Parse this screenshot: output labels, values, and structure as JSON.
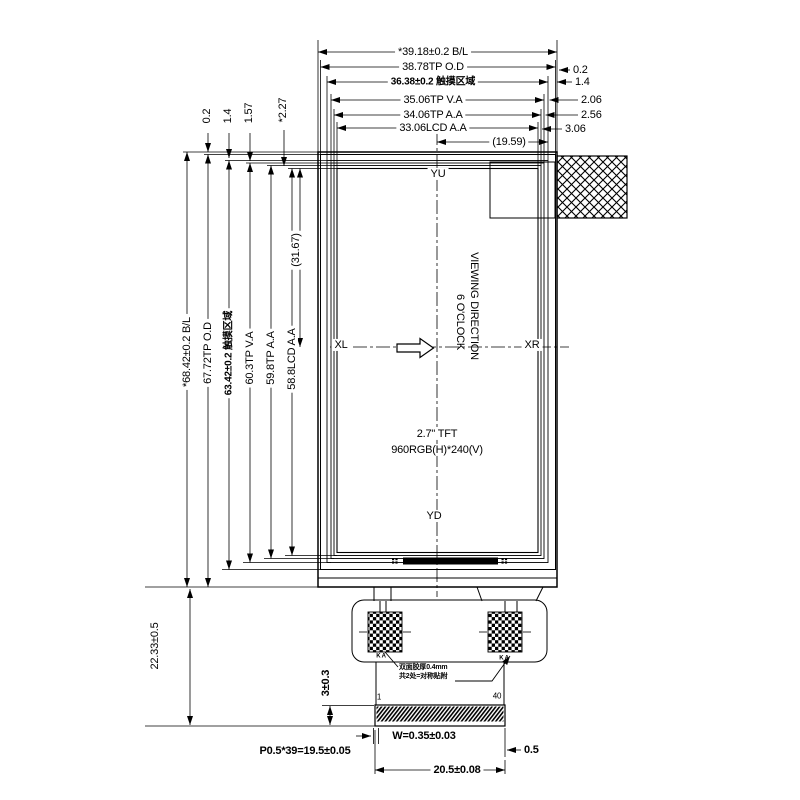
{
  "dims": {
    "top": [
      "*39.18±0.2 B/L",
      "38.78TP O.D",
      "36.38±0.2 触摸区域",
      "35.06TP V.A",
      "34.06TP A.A",
      "33.06LCD A.A"
    ],
    "top_half": "(19.59)",
    "right_offsets": [
      "0.2",
      "1.4",
      "2.06",
      "2.56",
      "3.06"
    ],
    "left": [
      "*68.42±0.2 B/L",
      "67.72TP O.D",
      "63.42±0.2 触摸区域",
      "60.3TP V.A",
      "59.8TP A.A",
      "58.8LCD A.A"
    ],
    "left_offsets": [
      "0.2",
      "1.4",
      "1.57",
      "*2.27"
    ],
    "left_half": "(31.67)",
    "bottom_height": "22.33±0.5",
    "fpc_connector_height": "3±0.3",
    "pin_pitch": "P0.5*39=19.5±0.05",
    "pin_width": "W=0.35±0.03",
    "edge_margin": "0.5",
    "connector_width": "20.5±0.08"
  },
  "panel": {
    "axis_top": "YU",
    "axis_bottom": "YD",
    "axis_left": "XL",
    "axis_right": "XR",
    "viewing_line1": "VIEWING DIRECTION",
    "viewing_line2": "6 O'CLOCK",
    "size_line1": "2.7\" TFT",
    "size_line2": "960RGB(H)*240(V)"
  },
  "fpc": {
    "pin_first": "1",
    "pin_last": "40",
    "pad_label_left": "K A",
    "pad_label_right": "K A",
    "note_line1": "双面胶厚0.4mm",
    "note_line2": "共2处=对称贴附"
  },
  "colors": {
    "line": "#000000",
    "background": "#ffffff"
  }
}
